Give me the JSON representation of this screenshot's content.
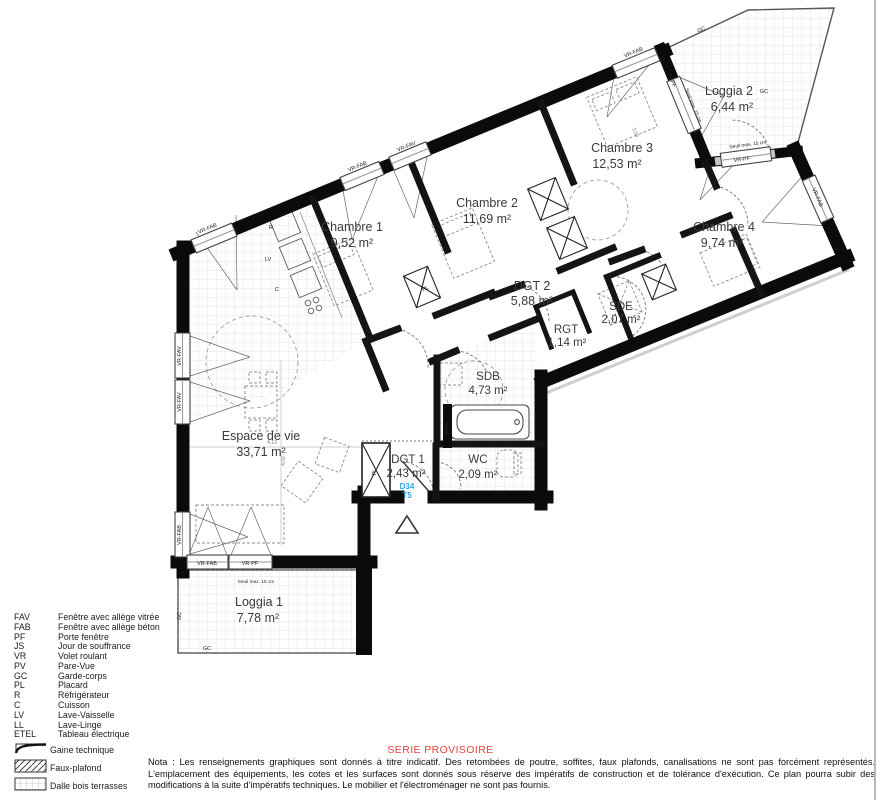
{
  "plan": {
    "unit": {
      "code": "D34",
      "type": "T5"
    },
    "rooms": [
      {
        "name": "Chambre 1",
        "area": "9,52 m²"
      },
      {
        "name": "Chambre 2",
        "area": "11,69 m²"
      },
      {
        "name": "Chambre 3",
        "area": "12,53 m²"
      },
      {
        "name": "Chambre 4",
        "area": "9,74 m²"
      },
      {
        "name": "Loggia 2",
        "area": "6,44 m²"
      },
      {
        "name": "DGT 2",
        "area": "5,88 m²"
      },
      {
        "name": "SDE",
        "area": "2,07 m²"
      },
      {
        "name": "RGT",
        "area": "1,14 m²"
      },
      {
        "name": "SDB",
        "area": "4,73 m²"
      },
      {
        "name": "Espace de vie",
        "area": "33,71 m²"
      },
      {
        "name": "DGT 1",
        "area": "2,43 m²"
      },
      {
        "name": "WC",
        "area": "2,09 m²"
      },
      {
        "name": "Loggia 1",
        "area": "7,78 m²"
      }
    ],
    "labels": {
      "vr_fab": "VR-FAB",
      "vr_fav": "VR-FAV",
      "vr_pf": "VR-PF",
      "seuil": "Seuil max. 15 cm",
      "gc": "GC",
      "pl": "PL",
      "r": "R",
      "lv": "LV",
      "c": "C",
      "ll": "LL",
      "etel": "ETEL"
    },
    "dims": [
      "4,13",
      "4,02",
      "3,50"
    ]
  },
  "legend": {
    "items": [
      {
        "code": "FAV",
        "label": "Fenêtre avec allège vitrée"
      },
      {
        "code": "FAB",
        "label": "Fenêtre avec allège béton"
      },
      {
        "code": "PF",
        "label": "Porte fenêtre"
      },
      {
        "code": "JS",
        "label": "Jour de souffrance"
      },
      {
        "code": "VR",
        "label": "Volet roulant"
      },
      {
        "code": "PV",
        "label": "Pare-Vue"
      },
      {
        "code": "GC",
        "label": "Garde-corps"
      },
      {
        "code": "PL",
        "label": "Placard"
      },
      {
        "code": "R",
        "label": "Réfrigérateur"
      },
      {
        "code": "C",
        "label": "Cuisson"
      },
      {
        "code": "LV",
        "label": "Lave-Vaisselle"
      },
      {
        "code": "LL",
        "label": "Lave-Linge"
      },
      {
        "code": "ETEL",
        "label": "Tableau électrique"
      }
    ],
    "swatches": [
      {
        "label": "Gaine technique"
      },
      {
        "label": "Faux-plafond"
      },
      {
        "label": "Dalle bois terrasses"
      }
    ]
  },
  "footer": {
    "serie": "SERIE PROVISOIRE",
    "nota": "Nota : Les renseignements graphiques sont donnés à titre indicatif. Des retombées de poutre, soffites, faux plafonds, canalisations ne sont pas forcément représentés. L'emplacement des équipements, les cotes et les surfaces sont donnés sous réserve des impératifs de construction et de tolérance d'exécution. Ce plan pourra subir des modifications à la suite d'impératifs techniques. Le mobilier et l'électroménager ne sont pas fournis."
  }
}
